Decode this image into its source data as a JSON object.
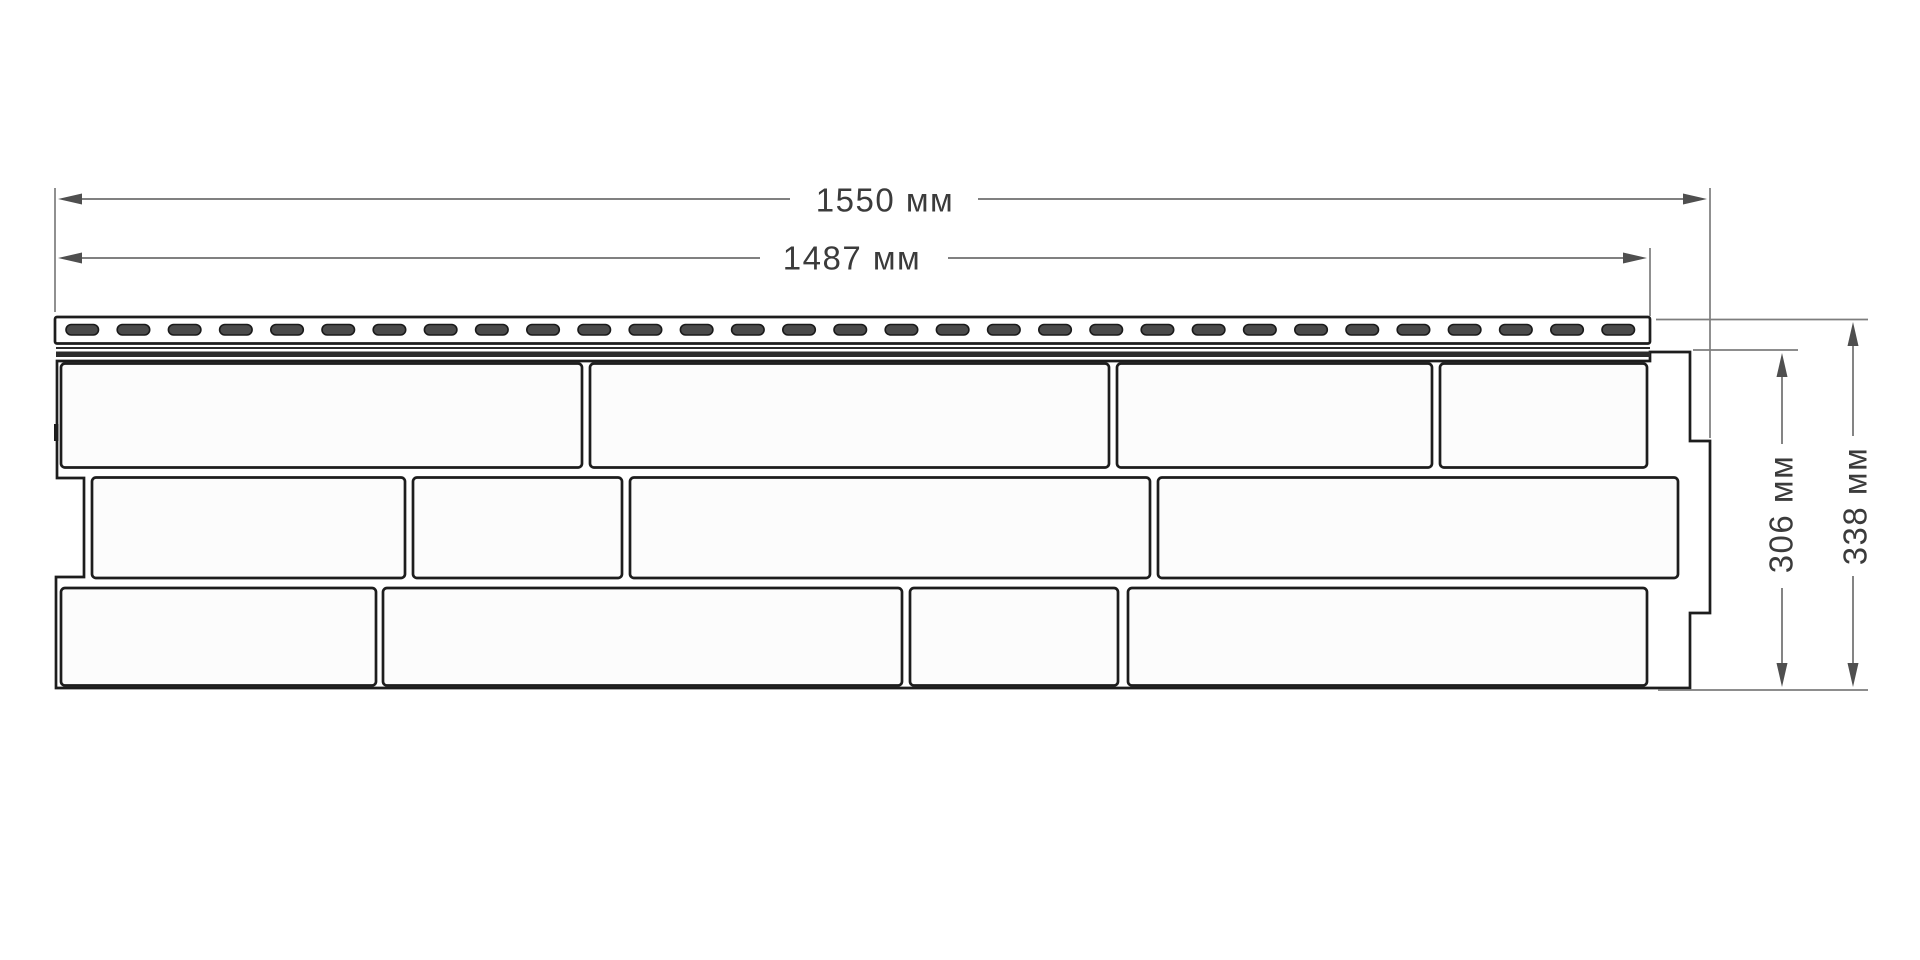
{
  "diagram": {
    "type": "technical-drawing",
    "subject": "facade-siding-panel-front-view",
    "units": "мм",
    "dimensions": {
      "total_width": {
        "label": "1550 мм",
        "value": 1550
      },
      "useful_width": {
        "label": "1487 мм",
        "value": 1487
      },
      "useful_height": {
        "label": "306 мм",
        "value": 306
      },
      "total_height": {
        "label": "338 мм",
        "value": 338
      }
    },
    "panel": {
      "rows_of_bricks": 3,
      "bricks_per_row": [
        4,
        4,
        4
      ],
      "nail_hem_perforations": 31
    },
    "colors": {
      "background": "#ffffff",
      "outline": "#1d1d1d",
      "brick_fill": "#fcfcfc",
      "perforation_fill": "#4a4a4a",
      "shadow_band": "#2b2b2b",
      "dimension_line": "#6e6e6e",
      "extension_line": "#7d7d7d",
      "arrow": "#4f4f4f",
      "text": "#3b3b3b"
    },
    "geometry": {
      "viewBox": "0 0 1920 960",
      "elements": [
        {
          "type": "path",
          "name": "panel-outline",
          "attrs": {
            "d": "M 57 361 L 1650 361 L 1650 352 L 1690 352 L 1690 441 L 1710 441 L 1710 613 L 1690 613 L 1690 688 L 56 688 L 56 577 L 84 577 L 84 478 L 57 478 Z",
            "fill": "#ffffff",
            "stroke": "#1d1d1d",
            "stroke-width": "2.7",
            "stroke-linejoin": "miter"
          }
        },
        {
          "type": "rect",
          "name": "brick",
          "attrs": {
            "x": "61",
            "y": "363.5",
            "width": "521",
            "height": "104",
            "rx": "4",
            "fill": "#fcfcfc",
            "stroke": "#1d1d1d",
            "stroke-width": "2.7"
          }
        },
        {
          "type": "rect",
          "name": "brick",
          "attrs": {
            "x": "590",
            "y": "363.5",
            "width": "519",
            "height": "104",
            "rx": "4",
            "fill": "#fcfcfc",
            "stroke": "#1d1d1d",
            "stroke-width": "2.7"
          }
        },
        {
          "type": "rect",
          "name": "brick",
          "attrs": {
            "x": "1117",
            "y": "363.5",
            "width": "315",
            "height": "104",
            "rx": "4",
            "fill": "#fcfcfc",
            "stroke": "#1d1d1d",
            "stroke-width": "2.7"
          }
        },
        {
          "type": "rect",
          "name": "brick",
          "attrs": {
            "x": "1440",
            "y": "363.5",
            "width": "207",
            "height": "104",
            "rx": "4",
            "fill": "#fcfcfc",
            "stroke": "#1d1d1d",
            "stroke-width": "2.7"
          }
        },
        {
          "type": "rect",
          "name": "brick",
          "attrs": {
            "x": "92",
            "y": "477.5",
            "width": "313",
            "height": "100.5",
            "rx": "4",
            "fill": "#fcfcfc",
            "stroke": "#1d1d1d",
            "stroke-width": "2.7"
          }
        },
        {
          "type": "rect",
          "name": "brick",
          "attrs": {
            "x": "413",
            "y": "477.5",
            "width": "209",
            "height": "100.5",
            "rx": "4",
            "fill": "#fcfcfc",
            "stroke": "#1d1d1d",
            "stroke-width": "2.7"
          }
        },
        {
          "type": "rect",
          "name": "brick",
          "attrs": {
            "x": "630",
            "y": "477.5",
            "width": "520",
            "height": "100.5",
            "rx": "4",
            "fill": "#fcfcfc",
            "stroke": "#1d1d1d",
            "stroke-width": "2.7"
          }
        },
        {
          "type": "rect",
          "name": "brick",
          "attrs": {
            "x": "1158",
            "y": "477.5",
            "width": "520",
            "height": "100.5",
            "rx": "4",
            "fill": "#fcfcfc",
            "stroke": "#1d1d1d",
            "stroke-width": "2.7"
          }
        },
        {
          "type": "rect",
          "name": "brick",
          "attrs": {
            "x": "61",
            "y": "588",
            "width": "315",
            "height": "97.5",
            "rx": "4",
            "fill": "#fcfcfc",
            "stroke": "#1d1d1d",
            "stroke-width": "2.7"
          }
        },
        {
          "type": "rect",
          "name": "brick",
          "attrs": {
            "x": "383",
            "y": "588",
            "width": "519",
            "height": "97.5",
            "rx": "4",
            "fill": "#fcfcfc",
            "stroke": "#1d1d1d",
            "stroke-width": "2.7"
          }
        },
        {
          "type": "rect",
          "name": "brick",
          "attrs": {
            "x": "910",
            "y": "588",
            "width": "208",
            "height": "97.5",
            "rx": "4",
            "fill": "#fcfcfc",
            "stroke": "#1d1d1d",
            "stroke-width": "2.7"
          }
        },
        {
          "type": "rect",
          "name": "brick",
          "attrs": {
            "x": "1128",
            "y": "588",
            "width": "519",
            "height": "97.5",
            "rx": "4",
            "fill": "#fcfcfc",
            "stroke": "#1d1d1d",
            "stroke-width": "2.7"
          }
        },
        {
          "type": "rect",
          "name": "nail-hem",
          "attrs": {
            "x": "55",
            "y": "317",
            "width": "1595",
            "height": "26.5",
            "rx": "2",
            "fill": "#ffffff",
            "stroke": "#1d1d1d",
            "stroke-width": "2.7"
          }
        },
        {
          "type": "repeat-rect",
          "name": "perforation-slot",
          "count": 31,
          "x0": 66,
          "step": 51.2,
          "y": 324.5,
          "w": 32.5,
          "h": 10.5,
          "rx": 5.25,
          "fill": "#4a4a4a",
          "stroke": "#1a1a1a",
          "sw": 1.6
        },
        {
          "type": "line",
          "name": "hem-lower-line",
          "attrs": {
            "x1": "56",
            "y1": "348",
            "x2": "1650",
            "y2": "348",
            "stroke": "#2b2b2b",
            "stroke-width": "2"
          }
        },
        {
          "type": "rect",
          "name": "hem-shadow-band",
          "attrs": {
            "x": "56",
            "y": "351.5",
            "width": "1594",
            "height": "5.5",
            "fill": "#2b2b2b"
          }
        },
        {
          "type": "rect",
          "name": "left-lock-mark",
          "attrs": {
            "x": "54",
            "y": "424",
            "width": "4.5",
            "height": "17",
            "fill": "#1d1d1d"
          }
        },
        {
          "type": "line",
          "name": "extension-line",
          "attrs": {
            "x1": "55",
            "y1": "188",
            "x2": "55",
            "y2": "312",
            "stroke": "#7d7d7d",
            "stroke-width": "1.7"
          }
        },
        {
          "type": "line",
          "name": "extension-line",
          "attrs": {
            "x1": "1710",
            "y1": "188",
            "x2": "1710",
            "y2": "438",
            "stroke": "#7d7d7d",
            "stroke-width": "1.7"
          }
        },
        {
          "type": "line",
          "name": "extension-line",
          "attrs": {
            "x1": "1650",
            "y1": "248",
            "x2": "1650",
            "y2": "316",
            "stroke": "#7d7d7d",
            "stroke-width": "1.7"
          }
        },
        {
          "type": "line",
          "name": "extension-line",
          "attrs": {
            "x1": "1656",
            "y1": "319.5",
            "x2": "1868",
            "y2": "319.5",
            "stroke": "#7d7d7d",
            "stroke-width": "1.7"
          }
        },
        {
          "type": "line",
          "name": "extension-line",
          "attrs": {
            "x1": "1693",
            "y1": "350",
            "x2": "1798",
            "y2": "350",
            "stroke": "#7d7d7d",
            "stroke-width": "1.7"
          }
        },
        {
          "type": "line",
          "name": "extension-line",
          "attrs": {
            "x1": "1658",
            "y1": "690",
            "x2": "1868",
            "y2": "690",
            "stroke": "#7d7d7d",
            "stroke-width": "1.7"
          }
        },
        {
          "type": "line",
          "name": "dimension-line-total-width",
          "attrs": {
            "x1": "70",
            "y1": "199",
            "x2": "790",
            "y2": "199",
            "stroke": "#6e6e6e",
            "stroke-width": "1.7"
          }
        },
        {
          "type": "line",
          "name": "dimension-line-total-width",
          "attrs": {
            "x1": "978",
            "y1": "199",
            "x2": "1696",
            "y2": "199",
            "stroke": "#6e6e6e",
            "stroke-width": "1.7"
          }
        },
        {
          "type": "line",
          "name": "dimension-line-useful-width",
          "attrs": {
            "x1": "70",
            "y1": "258",
            "x2": "760",
            "y2": "258",
            "stroke": "#6e6e6e",
            "stroke-width": "1.7"
          }
        },
        {
          "type": "line",
          "name": "dimension-line-useful-width",
          "attrs": {
            "x1": "948",
            "y1": "258",
            "x2": "1638",
            "y2": "258",
            "stroke": "#6e6e6e",
            "stroke-width": "1.7"
          }
        },
        {
          "type": "line",
          "name": "dimension-line-useful-height",
          "attrs": {
            "x1": "1782",
            "y1": "362",
            "x2": "1782",
            "y2": "444",
            "stroke": "#6e6e6e",
            "stroke-width": "1.7"
          }
        },
        {
          "type": "line",
          "name": "dimension-line-useful-height",
          "attrs": {
            "x1": "1782",
            "y1": "588",
            "x2": "1782",
            "y2": "676",
            "stroke": "#6e6e6e",
            "stroke-width": "1.7"
          }
        },
        {
          "type": "line",
          "name": "dimension-line-total-height",
          "attrs": {
            "x1": "1853",
            "y1": "333",
            "x2": "1853",
            "y2": "436",
            "stroke": "#6e6e6e",
            "stroke-width": "1.7"
          }
        },
        {
          "type": "line",
          "name": "dimension-line-total-height",
          "attrs": {
            "x1": "1853",
            "y1": "576",
            "x2": "1853",
            "y2": "675",
            "stroke": "#6e6e6e",
            "stroke-width": "1.7"
          }
        },
        {
          "type": "polygon",
          "name": "dimension-arrow",
          "attrs": {
            "points": "58,199 82,193.5 82,204.5",
            "fill": "#4f4f4f"
          }
        },
        {
          "type": "polygon",
          "name": "dimension-arrow",
          "attrs": {
            "points": "1707,199 1683,193.5 1683,204.5",
            "fill": "#4f4f4f"
          }
        },
        {
          "type": "polygon",
          "name": "dimension-arrow",
          "attrs": {
            "points": "58,258 82,252.5 82,263.5",
            "fill": "#4f4f4f"
          }
        },
        {
          "type": "polygon",
          "name": "dimension-arrow",
          "attrs": {
            "points": "1647,258 1623,252.5 1623,263.5",
            "fill": "#4f4f4f"
          }
        },
        {
          "type": "polygon",
          "name": "dimension-arrow",
          "attrs": {
            "points": "1782,353 1776.5,377 1787.5,377",
            "fill": "#4f4f4f"
          }
        },
        {
          "type": "polygon",
          "name": "dimension-arrow",
          "attrs": {
            "points": "1782,687 1776.5,663 1787.5,663",
            "fill": "#4f4f4f"
          }
        },
        {
          "type": "polygon",
          "name": "dimension-arrow",
          "attrs": {
            "points": "1853,322 1847.5,346 1858.5,346",
            "fill": "#4f4f4f"
          }
        },
        {
          "type": "polygon",
          "name": "dimension-arrow",
          "attrs": {
            "points": "1853,687 1847.5,663 1858.5,663",
            "fill": "#4f4f4f"
          }
        }
      ]
    }
  }
}
